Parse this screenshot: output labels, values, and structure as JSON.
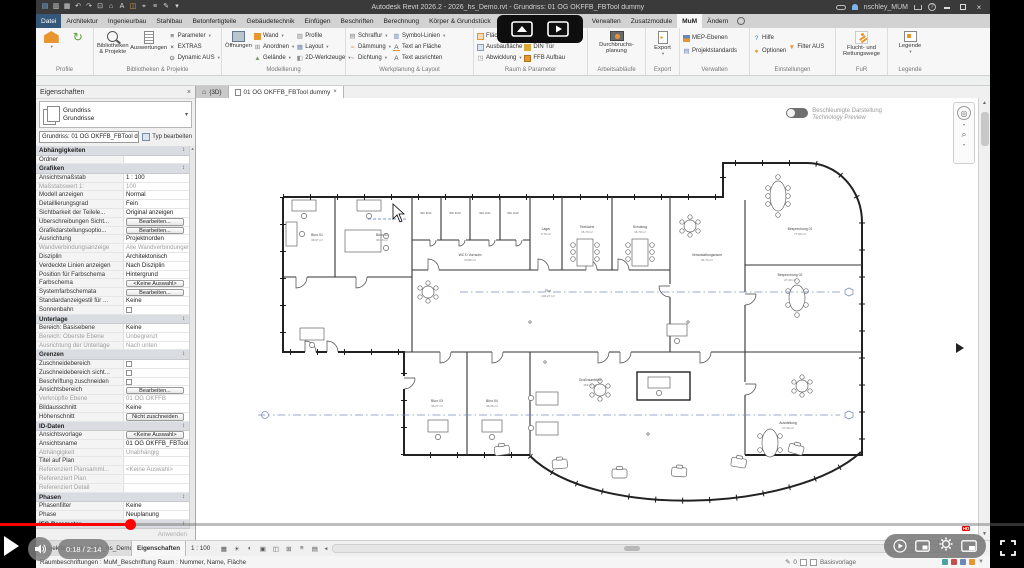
{
  "titlebar": {
    "title": "Autodesk Revit 2026.2 - 2026_hs_Demo.rvt - Grundriss: 01 OG OKFFB_FBTool dummy",
    "user": "nschley_MUM"
  },
  "icons": {
    "quick_access": [
      "new-file",
      "open",
      "save",
      "sync",
      "undo",
      "redo",
      "print",
      "measure",
      "text",
      "tag",
      "3d-view",
      "section",
      "customize"
    ],
    "titlebar_right": [
      "search-binoculars",
      "user-avatar",
      "cart",
      "help"
    ],
    "view_controls": [
      "visual-style",
      "sun-settings",
      "shadows",
      "crop-region",
      "show-crop",
      "temporary-hide",
      "reveal-hidden",
      "worksharing-display"
    ],
    "video_controls": [
      "play",
      "volume",
      "autoplay",
      "miniplayer",
      "settings",
      "pip",
      "fullscreen",
      "cast",
      "floating-player"
    ]
  },
  "ribbon_tabs": {
    "items": [
      "Datei",
      "Architektur",
      "Ingenieurbau",
      "Stahlbau",
      "Betonfertigteile",
      "Gebäudetechnik",
      "Einfügen",
      "Beschriften",
      "Berechnung",
      "Körper & Grundstück",
      "Zusammenarbeit",
      "Ansicht",
      "Verwalten",
      "Zusatzmodule",
      "MuM",
      "Ändern"
    ],
    "active": "MuM"
  },
  "ribbon": {
    "panels": [
      {
        "label": "Profile",
        "bigs": [],
        "smalls": []
      },
      {
        "label": "Bibliotheken & Projekte",
        "bigs": [
          "Bibliotheken & Projekte",
          "Auswertungen"
        ],
        "smalls": [
          "Parameter",
          "EXTRAS",
          "Dynamic AUS"
        ]
      },
      {
        "label": "Modellierung",
        "bigs": [
          "Öffnungen"
        ],
        "smalls": [
          "Wand",
          "Anordnen",
          "Gelände",
          "Profile",
          "Layout",
          "2D-Werkzeuge"
        ]
      },
      {
        "label": "Werkplanung & Layout",
        "bigs": [],
        "smalls": [
          "Schraffur",
          "Dämmung",
          "Dichtung",
          "Symbol-Linien",
          "Text an Fläche",
          "Text ausrichten"
        ]
      },
      {
        "label": "Raum & Parameter",
        "bigs": [],
        "smalls": [
          "Fläche",
          "Ausbaufläche",
          "Abwicklung",
          "Trigger",
          "DIN Tür",
          "FFB Aufbau"
        ]
      },
      {
        "label": "Arbeitsabläufe",
        "bigs": [
          "Durchbruchs-planung"
        ],
        "smalls": []
      },
      {
        "label": "Export",
        "bigs": [
          "Export"
        ],
        "smalls": []
      },
      {
        "label": "Verwalten",
        "bigs": [],
        "smalls": [
          "MEP-Ebenen",
          "Projektstandards"
        ]
      },
      {
        "label": "Einstellungen",
        "bigs": [],
        "smalls": [
          "Hilfe",
          "Optionen",
          "Filter AUS"
        ]
      },
      {
        "label": "FuR",
        "bigs": [
          "Flucht- und Rettungswege"
        ],
        "smalls": []
      },
      {
        "label": "Legende",
        "bigs": [
          "Legende"
        ],
        "smalls": []
      }
    ]
  },
  "properties": {
    "title": "Eigenschaften",
    "type_selector": {
      "line1": "Grundriss",
      "line2": "Grundrisse"
    },
    "instance_selector": "Grundriss: 01 OG OKFFB_FBTool dur",
    "edit_type_label": "Typ bearbeiten",
    "apply_label": "Anwenden",
    "rows": [
      {
        "t": "s",
        "l": "Abhängigkeiten"
      },
      {
        "t": "r",
        "l": "Ordner",
        "v": ""
      },
      {
        "t": "s",
        "l": "Grafiken"
      },
      {
        "t": "r",
        "l": "Ansichtsmaßstab",
        "v": "1 : 100"
      },
      {
        "t": "r",
        "l": "Maßstabswert 1:",
        "v": "100",
        "m": true
      },
      {
        "t": "r",
        "l": "Modell anzeigen",
        "v": "Normal"
      },
      {
        "t": "r",
        "l": "Detaillierungsgrad",
        "v": "Fein"
      },
      {
        "t": "r",
        "l": "Sichtbarkeit der Teilele...",
        "v": "Original anzeigen"
      },
      {
        "t": "b",
        "l": "Überschreibungen Sicht...",
        "v": "Bearbeiten..."
      },
      {
        "t": "b",
        "l": "Grafikdarstellungsoptio...",
        "v": "Bearbeiten..."
      },
      {
        "t": "r",
        "l": "Ausrichtung",
        "v": "Projektnorden"
      },
      {
        "t": "r",
        "l": "Wandverbindungsanzeige",
        "v": "Alle Wandverbindungen ...",
        "m": true
      },
      {
        "t": "r",
        "l": "Disziplin",
        "v": "Architektonisch"
      },
      {
        "t": "r",
        "l": "Verdeckte Linien anzeigen",
        "v": "Nach Disziplin"
      },
      {
        "t": "r",
        "l": "Position für Farbschema",
        "v": "Hintergrund"
      },
      {
        "t": "b",
        "l": "Farbschema",
        "v": "<Keine Auswahl>"
      },
      {
        "t": "b",
        "l": "Systemfarbschemata",
        "v": "Bearbeiten..."
      },
      {
        "t": "r",
        "l": "Standardanzeigestil für ...",
        "v": "Keine"
      },
      {
        "t": "c",
        "l": "Sonnenbahn"
      },
      {
        "t": "s",
        "l": "Unterlage"
      },
      {
        "t": "r",
        "l": "Bereich: Basisebene",
        "v": "Keine"
      },
      {
        "t": "r",
        "l": "Bereich: Oberste Ebene",
        "v": "Unbegrenzt",
        "m": true
      },
      {
        "t": "r",
        "l": "Ausrichtung der Unterlage",
        "v": "Nach unten",
        "m": true
      },
      {
        "t": "s",
        "l": "Grenzen"
      },
      {
        "t": "c",
        "l": "Zuschneidebereich"
      },
      {
        "t": "c",
        "l": "Zuschneidebereich sicht..."
      },
      {
        "t": "c",
        "l": "Beschriftung zuschneiden"
      },
      {
        "t": "b",
        "l": "Ansichtsbereich",
        "v": "Bearbeiten..."
      },
      {
        "t": "r",
        "l": "Verknüpfte Ebene",
        "v": "01 OG OKFFB",
        "m": true
      },
      {
        "t": "r",
        "l": "Bildausschnitt",
        "v": "Keine"
      },
      {
        "t": "b",
        "l": "Höhenschnitt",
        "v": "Nicht zuschneiden"
      },
      {
        "t": "s",
        "l": "ID-Daten"
      },
      {
        "t": "b",
        "l": "Ansichtsvorlage",
        "v": "<Keine Auswahl>"
      },
      {
        "t": "r",
        "l": "Ansichtsname",
        "v": "01 OG OKFFB_FBTool du..."
      },
      {
        "t": "r",
        "l": "Abhängigkeit",
        "v": "Unabhängig",
        "m": true
      },
      {
        "t": "r",
        "l": "Titel auf Plan",
        "v": ""
      },
      {
        "t": "r",
        "l": "Referenziert Plansamml...",
        "v": "<Keine Auswahl>",
        "m": true
      },
      {
        "t": "r",
        "l": "Referenziert Plan",
        "v": "",
        "m": true
      },
      {
        "t": "r",
        "l": "Referenziert Detail",
        "v": "",
        "m": true
      },
      {
        "t": "s",
        "l": "Phasen"
      },
      {
        "t": "r",
        "l": "Phasenfilter",
        "v": "Keine"
      },
      {
        "t": "r",
        "l": "Phase",
        "v": "Neuplanung"
      },
      {
        "t": "s",
        "l": "IFC-Parameter"
      },
      {
        "t": "i",
        "l": "IFCExportAs",
        "v": ""
      }
    ]
  },
  "view_tabs": {
    "tab_3d": "{3D}",
    "active_tab": "01 OG OKFFB_FBTool dummy"
  },
  "canvas": {
    "accel_toggle": {
      "label": "Beschleunigte Darstellung",
      "sublabel": "Technology Preview"
    },
    "plan": {
      "rooms": [
        {
          "name": "Büro 01",
          "area": "36.07 m²"
        },
        {
          "name": "Büro 02",
          "area": "36.46 m²"
        },
        {
          "name": "WC D Vorraum",
          "area": "10.80 m²"
        },
        {
          "name": "Lager",
          "area": "9.76 m²"
        },
        {
          "name": "Teeküche",
          "area": "16.73 m²"
        },
        {
          "name": "Schulung",
          "area": "16.73 m²"
        },
        {
          "name": "Flur",
          "area": "146.27 m²"
        },
        {
          "name": "Veranstaltungsraum",
          "area": "94.74 m²"
        },
        {
          "name": "Besprechung 01",
          "area": "77.80 m²"
        },
        {
          "name": "Besprechung 02",
          "area": "27.40 m²"
        },
        {
          "name": "Büro 03",
          "area": "36.27 m²"
        },
        {
          "name": "Büro 04",
          "area": "36.26 m²"
        },
        {
          "name": "Großraumbüro",
          "area": "163.77 m²"
        },
        {
          "name": "Ausstellung",
          "area": "27.40 m²"
        }
      ],
      "cells": [
        "WC D 01",
        "WC D 02",
        "WC H 01",
        "WC H 02"
      ]
    }
  },
  "bottom": {
    "palette_tabs": [
      "Projektbrowser - 2026_hs_Demo.rvt",
      "Eigenschaften"
    ],
    "scale": "1 : 100",
    "edit_count": "0",
    "status_mid": "Basisvorlage",
    "status_left": "Raumbeschriftungen : MuM_Beschriftung Raum : Nummer, Name, Fläche"
  },
  "video": {
    "time": "0:18 / 2:14",
    "quality": "HD"
  }
}
